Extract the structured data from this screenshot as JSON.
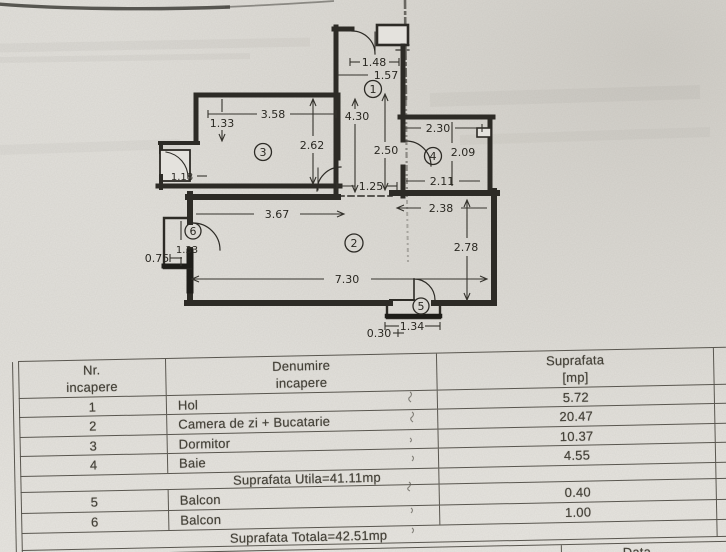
{
  "floorplan": {
    "room_numbers": {
      "hall": "1",
      "living": "2",
      "bedroom": "3",
      "bath": "4",
      "balcony5": "5",
      "balcony6": "6"
    },
    "dimensions": {
      "hall_top_width": "1.48",
      "hall_width": "1.57",
      "hall_height": "4.30",
      "hall_lower_height": "2.50",
      "hall_opening": "1.25",
      "bedroom_width": "3.58",
      "bedroom_left_height": "1.33",
      "bedroom_right_height": "2.62",
      "bedroom_door": "1.18",
      "bath_top_width": "2.30",
      "bath_right_height": "2.09",
      "bath_bottom_width": "2.11",
      "living_top_left_width": "3.67",
      "living_top_right_width": "2.38",
      "living_right_height": "2.78",
      "living_bottom_width": "7.30",
      "balcony6_height": "1.33",
      "balcony6_width": "0.75",
      "balcony5_width": "1.34",
      "balcony5_depth": "0.30"
    }
  },
  "table": {
    "header": {
      "col_nr_line1": "Nr.",
      "col_nr_line2": "incapere",
      "col_name_line1": "Denumire",
      "col_name_line2": "incapere",
      "col_area_line1": "Suprafata",
      "col_area_line2": "[mp]"
    },
    "rows_main": [
      {
        "nr": "1",
        "name": "Hol",
        "area": "5.72"
      },
      {
        "nr": "2",
        "name": "Camera de zi + Bucatarie",
        "area": "20.47"
      },
      {
        "nr": "3",
        "name": "Dormitor",
        "area": "10.37"
      },
      {
        "nr": "4",
        "name": "Baie",
        "area": "4.55"
      }
    ],
    "subtotal": "Suprafata Utila=41.11mp",
    "rows_balcony": [
      {
        "nr": "5",
        "name": "Balcon",
        "area": "0.40"
      },
      {
        "nr": "6",
        "name": "Balcon",
        "area": "1.00"
      }
    ],
    "total": "Suprafata Totala=42.51mp",
    "footer_label": "Data"
  }
}
